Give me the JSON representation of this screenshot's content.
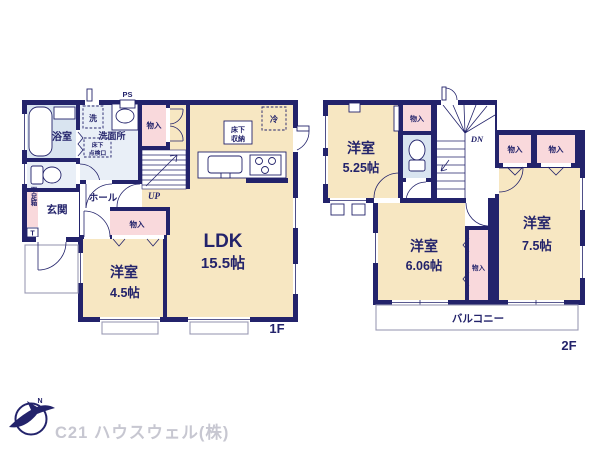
{
  "palette": {
    "navy": "#23236b",
    "cream": "#f7e7c2",
    "pink": "#f9d9dc",
    "bathblue": "#d9e4f0",
    "paleblue": "#e9eff7",
    "gray": "#9a9ab4",
    "logogray": "#c7c7d1"
  },
  "floor1": {
    "floor_label": "1F",
    "ldk": {
      "name": "LDK",
      "size": "15.5帖"
    },
    "western_room": {
      "name": "洋室",
      "size": "4.5帖"
    },
    "bath": "浴室",
    "washroom": "洗面所",
    "laundry": "洗",
    "inspection": [
      "床下",
      "点検口"
    ],
    "storage": [
      "床下",
      "収納"
    ],
    "fridge": "冷",
    "entrance": "玄関",
    "hall": "ホール",
    "shoe_box": "下足箱",
    "shoe_box_t": "T",
    "pipe_space": "PS",
    "closet_top": "物入",
    "closet_mid": "物入",
    "up": "UP"
  },
  "floor2": {
    "floor_label": "2F",
    "room_525": {
      "name": "洋室",
      "size": "5.25帖"
    },
    "room_606": {
      "name": "洋室",
      "size": "6.06帖"
    },
    "room_75": {
      "name": "洋室",
      "size": "7.5帖"
    },
    "closet_a": "物入",
    "closet_b": "物入",
    "closet_c": "物入",
    "closet_d": "物入",
    "down": "DN",
    "balcony": "バルコニー"
  },
  "logo": {
    "company": "C21 ハウスウェル(株)",
    "compass_north": "N"
  }
}
